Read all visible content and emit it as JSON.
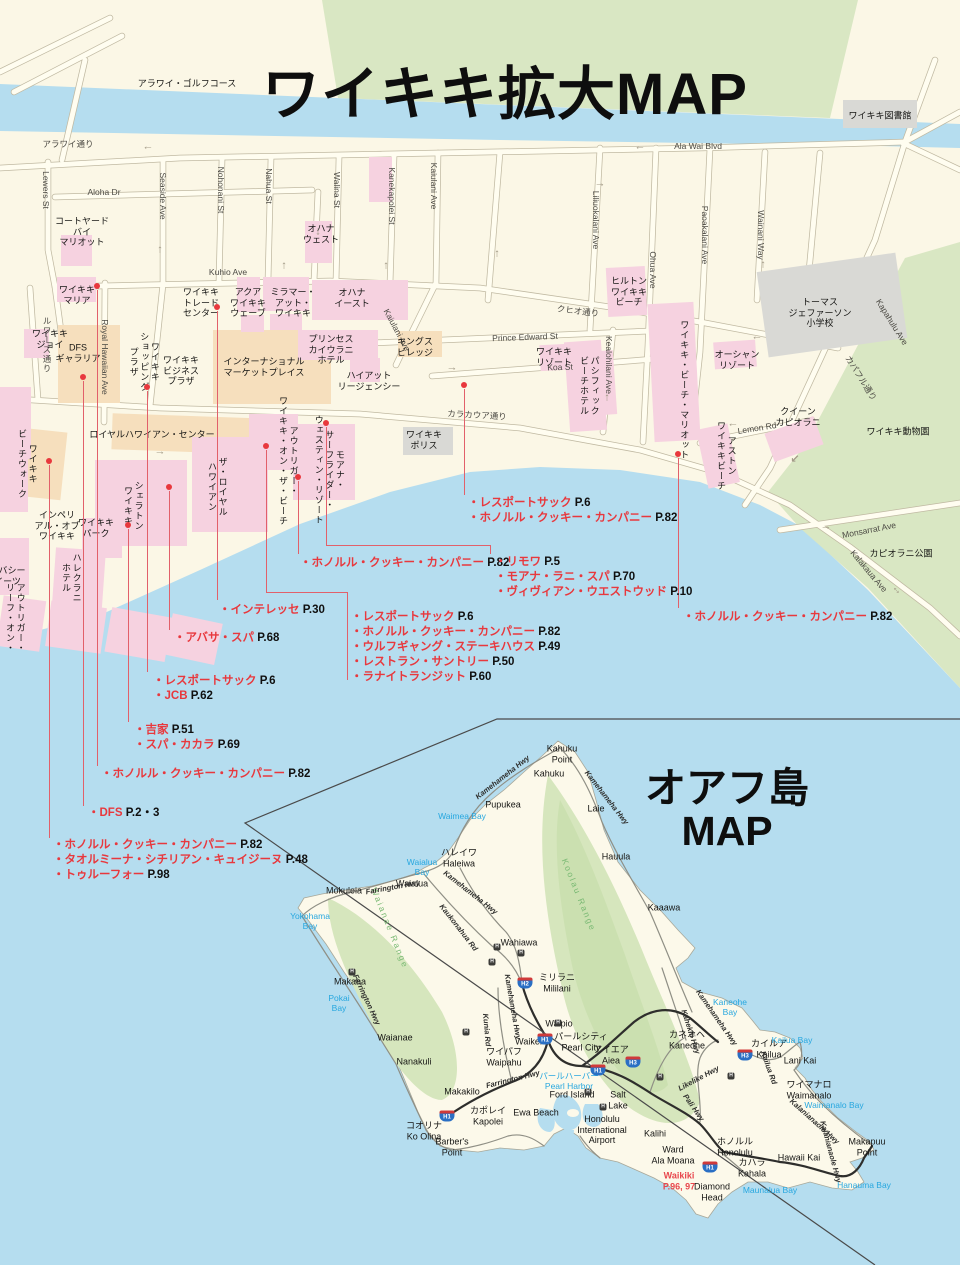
{
  "titles": {
    "waikiki": "ワイキキ拡大MAP",
    "oahu_line1": "オアフ島",
    "oahu_line2": "MAP"
  },
  "colors": {
    "sea": "#b5ddef",
    "land": "#fbf7e6",
    "park_green": "#d9e7c3",
    "pink": "#f6d2e0",
    "tan": "#f6dfbd",
    "gray": "#d9d9d5",
    "accent_red": "#e8383d",
    "water_text": "#27a7df"
  },
  "waikiki": {
    "streets": [
      {
        "t": "アラワイ通り",
        "x": 68,
        "y": 144
      },
      {
        "t": "Ala Wai Blvd",
        "x": 698,
        "y": 146
      },
      {
        "t": "Aloha Dr",
        "x": 104,
        "y": 192
      },
      {
        "t": "Kuhio Ave",
        "x": 228,
        "y": 272
      },
      {
        "t": "クヒオ通り",
        "x": 578,
        "y": 311,
        "r": 7
      },
      {
        "t": "Prince Edward St",
        "x": 525,
        "y": 337,
        "r": -2
      },
      {
        "t": "Koa St",
        "x": 560,
        "y": 367,
        "r": -2
      },
      {
        "t": "カラカウア通り",
        "x": 477,
        "y": 415,
        "r": 3
      },
      {
        "t": "Lemon Rd",
        "x": 757,
        "y": 428,
        "r": -9
      },
      {
        "t": "Monsarrat Ave",
        "x": 869,
        "y": 530,
        "r": -11
      },
      {
        "t": "Kalakaua Ave",
        "x": 869,
        "y": 571,
        "r": 50
      },
      {
        "t": "Kapahulu Ave",
        "x": 892,
        "y": 322,
        "r": 58
      },
      {
        "t": "カパフル通り",
        "x": 861,
        "y": 378,
        "r": 58
      },
      {
        "t": "Lewers St",
        "x": 46,
        "y": 190,
        "r": 90
      },
      {
        "t": "Seaside Ave",
        "x": 163,
        "y": 196,
        "r": 90
      },
      {
        "t": "Nohonani St",
        "x": 221,
        "y": 190,
        "r": 90
      },
      {
        "t": "Nahua St",
        "x": 269,
        "y": 186,
        "r": 90
      },
      {
        "t": "Walina St",
        "x": 337,
        "y": 190,
        "r": 90
      },
      {
        "t": "Kanekapolei St",
        "x": 392,
        "y": 196,
        "r": 90
      },
      {
        "t": "Kaiulani Ave",
        "x": 434,
        "y": 186,
        "r": 90
      },
      {
        "t": "Kaiulani Ave",
        "x": 397,
        "y": 330,
        "r": 62
      },
      {
        "t": "Liliuokalani Ave",
        "x": 596,
        "y": 220,
        "r": 90
      },
      {
        "t": "Ohua Ave",
        "x": 653,
        "y": 270,
        "r": 90
      },
      {
        "t": "Paoakalani Ave",
        "x": 705,
        "y": 235,
        "r": 90
      },
      {
        "t": "Wainani Way",
        "x": 761,
        "y": 235,
        "r": 90
      },
      {
        "t": "Kealohilani Ave",
        "x": 609,
        "y": 365,
        "r": 90
      },
      {
        "t": "Royal Hawaiian Ave",
        "x": 105,
        "y": 357,
        "r": 90
      },
      {
        "t": "ルワーズ通り",
        "x": 47,
        "y": 345,
        "v": 1
      }
    ],
    "places": [
      {
        "t": "アラワイ・ゴルフコース",
        "x": 187,
        "y": 84
      },
      {
        "t": "ワイキキ図書館",
        "x": 880,
        "y": 116
      },
      {
        "t": "コートヤード\nバイ\nマリオット",
        "x": 82,
        "y": 232
      },
      {
        "t": "オハナ\nウェスト",
        "x": 321,
        "y": 234
      },
      {
        "t": "ワイキキ\nマリア",
        "x": 77,
        "y": 295
      },
      {
        "t": "ヒルトン\nワイキキ\nビーチ",
        "x": 629,
        "y": 292
      },
      {
        "t": "ワイキキ\nトレード\nセンター",
        "x": 201,
        "y": 303
      },
      {
        "t": "アクア\nワイキキ\nウェーブ",
        "x": 248,
        "y": 303
      },
      {
        "t": "ミラマー・\nアット・\nワイキキ",
        "x": 293,
        "y": 303
      },
      {
        "t": "オハナ\nイースト",
        "x": 352,
        "y": 298
      },
      {
        "t": "プリンセス\nカイウラニ\nホテル",
        "x": 331,
        "y": 350
      },
      {
        "t": "キングス\nビレッジ",
        "x": 415,
        "y": 347
      },
      {
        "t": "ワイキキ\nリゾート",
        "x": 554,
        "y": 357
      },
      {
        "t": "パシフィック\nビーチホテル",
        "x": 589,
        "y": 386,
        "v": 1
      },
      {
        "t": "ハイアット\nリージェンシー",
        "x": 369,
        "y": 381
      },
      {
        "t": "ワイキキ\nポリス",
        "x": 424,
        "y": 440
      },
      {
        "t": "ロイヤルハワイアン・センター",
        "x": 152,
        "y": 435
      },
      {
        "t": "トーマス\nジェファーソン\n小学校",
        "x": 820,
        "y": 313
      },
      {
        "t": "オーシャン\nリゾート",
        "x": 737,
        "y": 360
      },
      {
        "t": "クイーン\nカピオラニ",
        "x": 798,
        "y": 417
      },
      {
        "t": "ワイキキ動物園",
        "x": 898,
        "y": 432
      },
      {
        "t": "カピオラニ公園",
        "x": 901,
        "y": 554
      },
      {
        "t": "ワイキキ\nジョイ",
        "x": 50,
        "y": 339
      },
      {
        "t": "DFS\nギャラリア",
        "x": 78,
        "y": 353
      },
      {
        "t": "ワイキキ\nショッピング\nプラザ",
        "x": 144,
        "y": 362,
        "v": 1
      },
      {
        "t": "ワイキキ\nビジネス\nプラザ",
        "x": 181,
        "y": 371
      },
      {
        "t": "インターナショナル\nマーケットプレイス",
        "x": 264,
        "y": 367
      },
      {
        "t": "モアナ・\nサーフライダー・\nウェスティン・リゾート",
        "x": 329,
        "y": 470,
        "v": 1
      },
      {
        "t": "シェラトン\nワイキキ",
        "x": 133,
        "y": 506,
        "v": 1
      },
      {
        "t": "ザ・ロイヤル\nハワイアン",
        "x": 217,
        "y": 487,
        "v": 1
      },
      {
        "t": "アウトリガー・\nワイキキ・オン・ザ・ビーチ",
        "x": 288,
        "y": 461,
        "v": 1
      },
      {
        "t": "ワイキキ\nビーチウォーク",
        "x": 27,
        "y": 464,
        "v": 1
      },
      {
        "t": "インペリ\nアル・オブ\nワイキキ",
        "x": 57,
        "y": 526
      },
      {
        "t": "ワイキキ\nパーク",
        "x": 96,
        "y": 528
      },
      {
        "t": "ハレクラニ\nホテル",
        "x": 71,
        "y": 578,
        "v": 1
      },
      {
        "t": "エンバシー\nスイーツ",
        "x": 3,
        "y": 576
      },
      {
        "t": "アウトリガー・\nリーフ・オン・",
        "x": 15,
        "y": 618,
        "v": 1
      },
      {
        "t": "ワイキキ・ビーチ・マリオット",
        "x": 684,
        "y": 390,
        "v": 1
      },
      {
        "t": "アストン\nワイキキビーチ",
        "x": 726,
        "y": 456,
        "v": 1
      }
    ],
    "arrows": [
      {
        "t": "←",
        "x": 148,
        "y": 147
      },
      {
        "t": "←",
        "x": 640,
        "y": 147
      },
      {
        "t": "↓",
        "x": 318,
        "y": 232
      },
      {
        "t": "↑",
        "x": 160,
        "y": 250
      },
      {
        "t": "↑",
        "x": 284,
        "y": 266
      },
      {
        "t": "↑",
        "x": 386,
        "y": 266
      },
      {
        "t": "↑",
        "x": 497,
        "y": 254
      },
      {
        "t": "→",
        "x": 600,
        "y": 184
      },
      {
        "t": "←",
        "x": 757,
        "y": 337
      },
      {
        "t": "→",
        "x": 452,
        "y": 368
      },
      {
        "t": "←",
        "x": 733,
        "y": 424
      },
      {
        "t": "→",
        "x": 826,
        "y": 527
      },
      {
        "t": "↙",
        "x": 795,
        "y": 460
      },
      {
        "t": "↑",
        "x": 763,
        "y": 265
      },
      {
        "t": "→",
        "x": 160,
        "y": 452
      },
      {
        "t": "↑",
        "x": 607,
        "y": 398
      },
      {
        "t": "↔",
        "x": 897,
        "y": 590,
        "r": 50
      }
    ],
    "dots": [
      [
        97,
        286
      ],
      [
        217,
        307
      ],
      [
        83,
        377
      ],
      [
        147,
        387
      ],
      [
        464,
        385
      ],
      [
        49,
        461
      ],
      [
        266,
        446
      ],
      [
        169,
        487
      ],
      [
        128,
        525
      ],
      [
        298,
        477
      ],
      [
        326,
        423
      ],
      [
        678,
        454
      ]
    ],
    "lines": [
      [
        97,
        290,
        97,
        766
      ],
      [
        83,
        381,
        83,
        806
      ],
      [
        49,
        465,
        49,
        838
      ],
      [
        128,
        529,
        128,
        722
      ],
      [
        147,
        391,
        147,
        672
      ],
      [
        169,
        491,
        169,
        630
      ],
      [
        217,
        311,
        217,
        600
      ],
      [
        298,
        481,
        298,
        554
      ],
      [
        464,
        389,
        464,
        495
      ],
      [
        326,
        427,
        326,
        545
      ],
      [
        326,
        545,
        490,
        545
      ],
      [
        490,
        545,
        490,
        554
      ],
      [
        266,
        450,
        266,
        592
      ],
      [
        266,
        592,
        347,
        592
      ],
      [
        347,
        592,
        347,
        680
      ],
      [
        678,
        458,
        678,
        608
      ]
    ],
    "shop_lists": [
      {
        "x": 468,
        "y": 496,
        "items": [
          {
            "n": "レスポートサック",
            "p": "P.6"
          },
          {
            "n": "ホノルル・クッキー・カンパニー",
            "p": "P.82"
          }
        ]
      },
      {
        "x": 300,
        "y": 556,
        "items": [
          {
            "n": "ホノルル・クッキー・カンパニー",
            "p": "P.82"
          }
        ]
      },
      {
        "x": 495,
        "y": 555,
        "items": [
          {
            "n": "リモワ",
            "p": "P.5"
          },
          {
            "n": "モアナ・ラニ・スパ",
            "p": "P.70"
          },
          {
            "n": "ヴィヴィアン・ウエストウッド",
            "p": "P.10"
          }
        ]
      },
      {
        "x": 351,
        "y": 610,
        "items": [
          {
            "n": "レスポートサック",
            "p": "P.6"
          },
          {
            "n": "ホノルル・クッキー・カンパニー",
            "p": "P.82"
          },
          {
            "n": "ウルフギャング・ステーキハウス",
            "p": "P.49"
          },
          {
            "n": "レストラン・サントリー",
            "p": "P.50"
          },
          {
            "n": "ラナイトランジット",
            "p": "P.60"
          }
        ]
      },
      {
        "x": 219,
        "y": 603,
        "items": [
          {
            "n": "インテレッセ",
            "p": "P.30"
          }
        ]
      },
      {
        "x": 174,
        "y": 631,
        "items": [
          {
            "n": "アバサ・スパ",
            "p": "P.68"
          }
        ]
      },
      {
        "x": 153,
        "y": 674,
        "items": [
          {
            "n": "レスポートサック",
            "p": "P.6"
          },
          {
            "n": "JCB",
            "p": "P.62"
          }
        ]
      },
      {
        "x": 134,
        "y": 723,
        "items": [
          {
            "n": "吉家",
            "p": "P.51"
          },
          {
            "n": "スパ・カカラ",
            "p": "P.69"
          }
        ]
      },
      {
        "x": 101,
        "y": 767,
        "items": [
          {
            "n": "ホノルル・クッキー・カンパニー",
            "p": "P.82"
          }
        ]
      },
      {
        "x": 88,
        "y": 806,
        "items": [
          {
            "n": "DFS",
            "p": "P.2・3"
          }
        ]
      },
      {
        "x": 53,
        "y": 838,
        "items": [
          {
            "n": "ホノルル・クッキー・カンパニー",
            "p": "P.82"
          },
          {
            "n": "タオルミーナ・シチリアン・キュイジーヌ",
            "p": "P.48"
          },
          {
            "n": "トゥルーフォー",
            "p": "P.98"
          }
        ]
      },
      {
        "x": 683,
        "y": 610,
        "items": [
          {
            "n": "ホノルル・クッキー・カンパニー",
            "p": "P.82"
          }
        ]
      }
    ]
  },
  "oahu": {
    "places": [
      {
        "t": "Kahuku\nPoint",
        "x": 562,
        "y": 754
      },
      {
        "t": "Kahuku",
        "x": 549,
        "y": 774
      },
      {
        "t": "Pupukea",
        "x": 503,
        "y": 805
      },
      {
        "t": "Laie",
        "x": 596,
        "y": 809
      },
      {
        "t": "Hauula",
        "x": 616,
        "y": 857
      },
      {
        "t": "Kaaawa",
        "x": 664,
        "y": 908
      },
      {
        "t": "ハレイワ\nHaleiwa",
        "x": 459,
        "y": 858
      },
      {
        "t": "Waialua",
        "x": 412,
        "y": 884
      },
      {
        "t": "Mokuleia",
        "x": 344,
        "y": 891
      },
      {
        "t": "Makaha",
        "x": 350,
        "y": 982
      },
      {
        "t": "Waianae",
        "x": 395,
        "y": 1038
      },
      {
        "t": "Nanakuli",
        "x": 414,
        "y": 1062
      },
      {
        "t": "Wahiawa",
        "x": 519,
        "y": 943
      },
      {
        "t": "ミリラニ\nMililani",
        "x": 557,
        "y": 983
      },
      {
        "t": "Waipio",
        "x": 559,
        "y": 1024
      },
      {
        "t": "Waikele",
        "x": 531,
        "y": 1042
      },
      {
        "t": "ワイパフ\nWaipahu",
        "x": 504,
        "y": 1057
      },
      {
        "t": "パールシティ\nPearl City",
        "x": 581,
        "y": 1042
      },
      {
        "t": "Makakilo",
        "x": 462,
        "y": 1092
      },
      {
        "t": "カポレイ\nKapolei",
        "x": 488,
        "y": 1116
      },
      {
        "t": "Ewa Beach",
        "x": 536,
        "y": 1113
      },
      {
        "t": "コオリナ\nKo Olina",
        "x": 424,
        "y": 1131
      },
      {
        "t": "Barber's\nPoint",
        "x": 452,
        "y": 1147
      },
      {
        "t": "アイエア\nAiea",
        "x": 611,
        "y": 1055
      },
      {
        "t": "Ford Island",
        "x": 572,
        "y": 1095
      },
      {
        "t": "Salt\nLake",
        "x": 618,
        "y": 1100
      },
      {
        "t": "Honolulu\nInternational\nAirport",
        "x": 602,
        "y": 1130
      },
      {
        "t": "Kalihi",
        "x": 655,
        "y": 1134
      },
      {
        "t": "Ward\nAla Moana",
        "x": 673,
        "y": 1155
      },
      {
        "t": "カネオヘ\nKaneohe",
        "x": 687,
        "y": 1040
      },
      {
        "t": "カイルア\nKailua",
        "x": 769,
        "y": 1049
      },
      {
        "t": "Lani Kai",
        "x": 800,
        "y": 1061
      },
      {
        "t": "ワイマナロ\nWaimanalo",
        "x": 809,
        "y": 1090
      },
      {
        "t": "Hawaii Kai",
        "x": 799,
        "y": 1158
      },
      {
        "t": "Makapuu\nPoint",
        "x": 867,
        "y": 1147
      },
      {
        "t": "ホノルル\nHonolulu",
        "x": 735,
        "y": 1147
      },
      {
        "t": "カハラ\nKahala",
        "x": 752,
        "y": 1168
      },
      {
        "t": "Diamond\nHead",
        "x": 712,
        "y": 1192
      }
    ],
    "water": [
      {
        "t": "Waimea Bay",
        "x": 462,
        "y": 816
      },
      {
        "t": "Waialua\nBay",
        "x": 422,
        "y": 867
      },
      {
        "t": "Yokohama\nBay",
        "x": 310,
        "y": 921
      },
      {
        "t": "Pokai\nBay",
        "x": 339,
        "y": 1003
      },
      {
        "t": "Kaneohe\nBay",
        "x": 730,
        "y": 1007
      },
      {
        "t": "Kailua Bay",
        "x": 792,
        "y": 1040
      },
      {
        "t": "Waimanalo Bay",
        "x": 834,
        "y": 1105
      },
      {
        "t": "Hanauma Bay",
        "x": 864,
        "y": 1185
      },
      {
        "t": "Maunalua Bay",
        "x": 770,
        "y": 1190
      },
      {
        "t": "パールハーバー\nPearl Harbor",
        "x": 569,
        "y": 1081
      }
    ],
    "ranges": [
      {
        "t": "Koolau Range",
        "x": 579,
        "y": 895,
        "r": 68
      },
      {
        "t": "Waianae Range",
        "x": 390,
        "y": 928,
        "r": 68
      }
    ],
    "highways": [
      {
        "t": "Kamehameha Hwy",
        "x": 503,
        "y": 778,
        "r": -38
      },
      {
        "t": "Kamehameha Hwy",
        "x": 606,
        "y": 798,
        "r": 52
      },
      {
        "t": "Farrington Hwy",
        "x": 393,
        "y": 888,
        "r": -10
      },
      {
        "t": "Kamehameha Hwy",
        "x": 470,
        "y": 893,
        "r": 38
      },
      {
        "t": "Kaukonahua Rd",
        "x": 458,
        "y": 928,
        "r": 52
      },
      {
        "t": "Kamehameha Hwy",
        "x": 512,
        "y": 1007,
        "r": 80
      },
      {
        "t": "Kunia Rd",
        "x": 486,
        "y": 1030,
        "r": 85
      },
      {
        "t": "Farrington Hwy",
        "x": 366,
        "y": 1000,
        "r": 65
      },
      {
        "t": "Farrington Hwy",
        "x": 513,
        "y": 1080,
        "r": -14
      },
      {
        "t": "Kahekili Hwy",
        "x": 690,
        "y": 1032,
        "r": 72
      },
      {
        "t": "Kamehameha Hwy",
        "x": 716,
        "y": 1018,
        "r": 55
      },
      {
        "t": "Likelike Hwy",
        "x": 699,
        "y": 1079,
        "r": -28
      },
      {
        "t": "Pali Hwy",
        "x": 693,
        "y": 1108,
        "r": 55
      },
      {
        "t": "Kailua Rd",
        "x": 768,
        "y": 1068,
        "r": 70
      },
      {
        "t": "Kalanianaole Hwy",
        "x": 814,
        "y": 1122,
        "r": 42
      },
      {
        "t": "Kalanianaole Hwy",
        "x": 830,
        "y": 1152,
        "r": 75
      }
    ],
    "red_places": [
      {
        "t": "Waikiki\nP.96, 97",
        "x": 679,
        "y": 1181
      }
    ],
    "shields": [
      {
        "t": "H2",
        "x": 525,
        "y": 983
      },
      {
        "t": "H1",
        "x": 545,
        "y": 1039
      },
      {
        "t": "H1",
        "x": 598,
        "y": 1070
      },
      {
        "t": "H3",
        "x": 633,
        "y": 1062
      },
      {
        "t": "H3",
        "x": 745,
        "y": 1055
      },
      {
        "t": "H1",
        "x": 710,
        "y": 1167
      },
      {
        "t": "H1",
        "x": 447,
        "y": 1116
      }
    ],
    "junctions": [
      [
        497,
        947
      ],
      [
        521,
        953
      ],
      [
        492,
        962
      ],
      [
        466,
        1032
      ],
      [
        352,
        972
      ],
      [
        558,
        1023
      ],
      [
        603,
        1107
      ],
      [
        660,
        1077
      ],
      [
        731,
        1076
      ],
      [
        588,
        1092
      ]
    ]
  }
}
